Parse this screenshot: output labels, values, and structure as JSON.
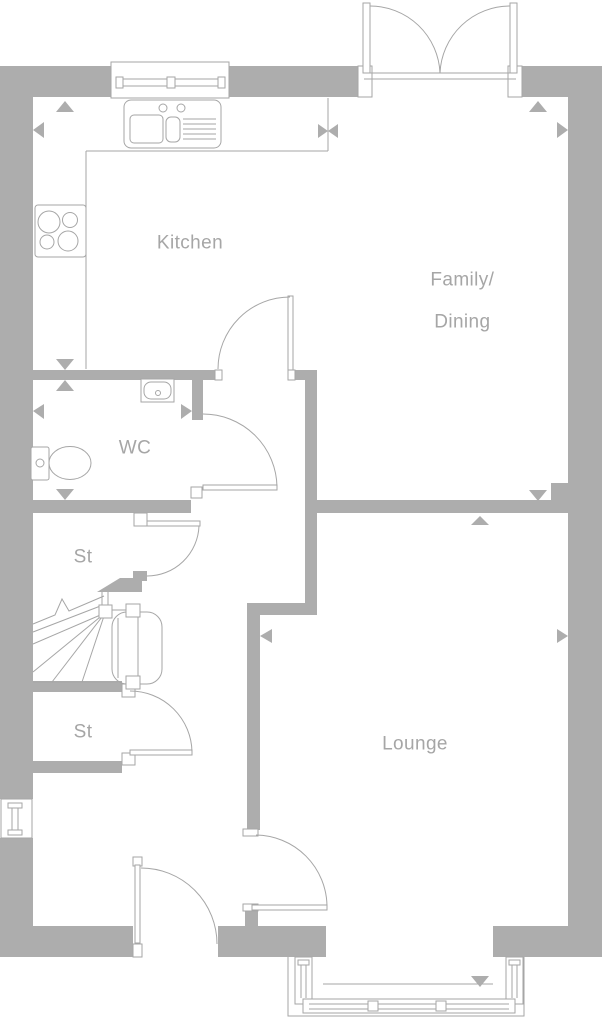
{
  "plan": {
    "title": "Ground floor plan",
    "colors": {
      "wall": "#adadad",
      "line": "#a6a6a6",
      "label_text": "#a6a6a6",
      "background": "#ffffff"
    },
    "rooms": [
      {
        "id": "kitchen",
        "label": "Kitchen"
      },
      {
        "id": "family_dining",
        "line1": "Family/",
        "line2": "Dining"
      },
      {
        "id": "wc",
        "label": "WC"
      },
      {
        "id": "st_upper",
        "label": "St"
      },
      {
        "id": "st_lower",
        "label": "St"
      },
      {
        "id": "lounge",
        "label": "Lounge"
      }
    ],
    "fixtures": [
      "kitchen-sink-icon",
      "hob-icon",
      "wash-basin-icon",
      "toilet-icon",
      "staircase-icon",
      "kitchen-window-icon",
      "side-window-icon",
      "bay-window-icon",
      "french-doors-icon",
      "single-door-icon",
      "dimension-arrow-icon"
    ]
  }
}
